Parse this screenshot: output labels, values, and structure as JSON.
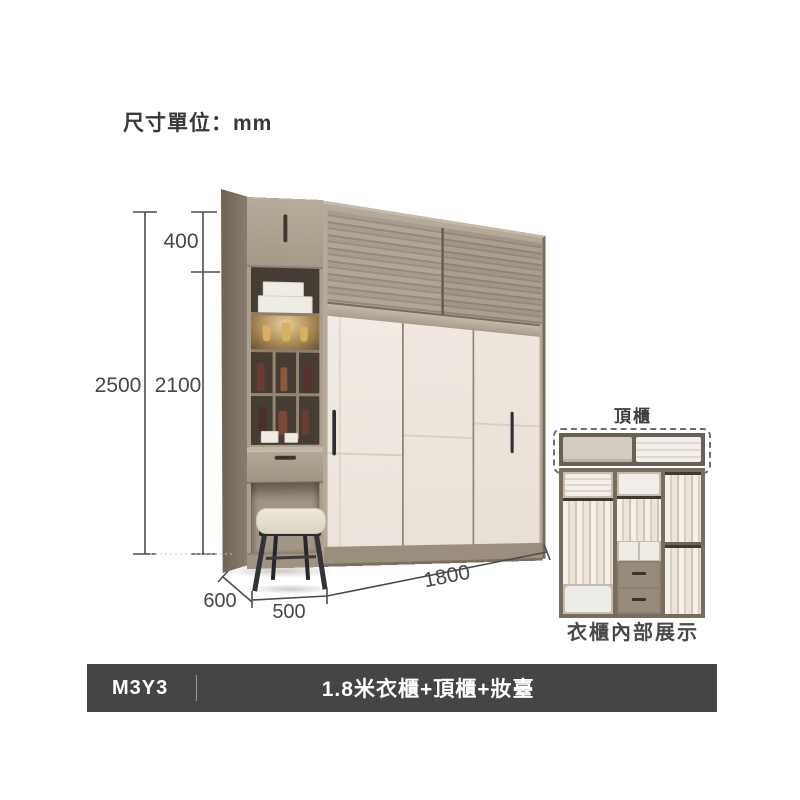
{
  "page": {
    "unit_label": "尺寸單位：mm"
  },
  "dimensions": {
    "total_height": "2500",
    "top_cabinet_height": "400",
    "main_height": "2100",
    "depth": "600",
    "vanity_width": "500",
    "wardrobe_width": "1800"
  },
  "inset": {
    "top_cabinet_label": "頂櫃",
    "caption": "衣櫃內部展示"
  },
  "footer": {
    "model": "M3Y3",
    "product_title": "1.8米衣櫃+頂櫃+妝臺"
  },
  "colors": {
    "wood_light": "#b5a999",
    "wood_grain": "#9a8e7f",
    "wood_dark": "#776b5d",
    "door_cream": "#f0e9e1",
    "niche_interior": "#453c33",
    "handle_dark": "#2e2e34",
    "cushion": "#e9e2d2",
    "footer_bar": "#454545",
    "dimension_line": "#4c4c4c"
  }
}
